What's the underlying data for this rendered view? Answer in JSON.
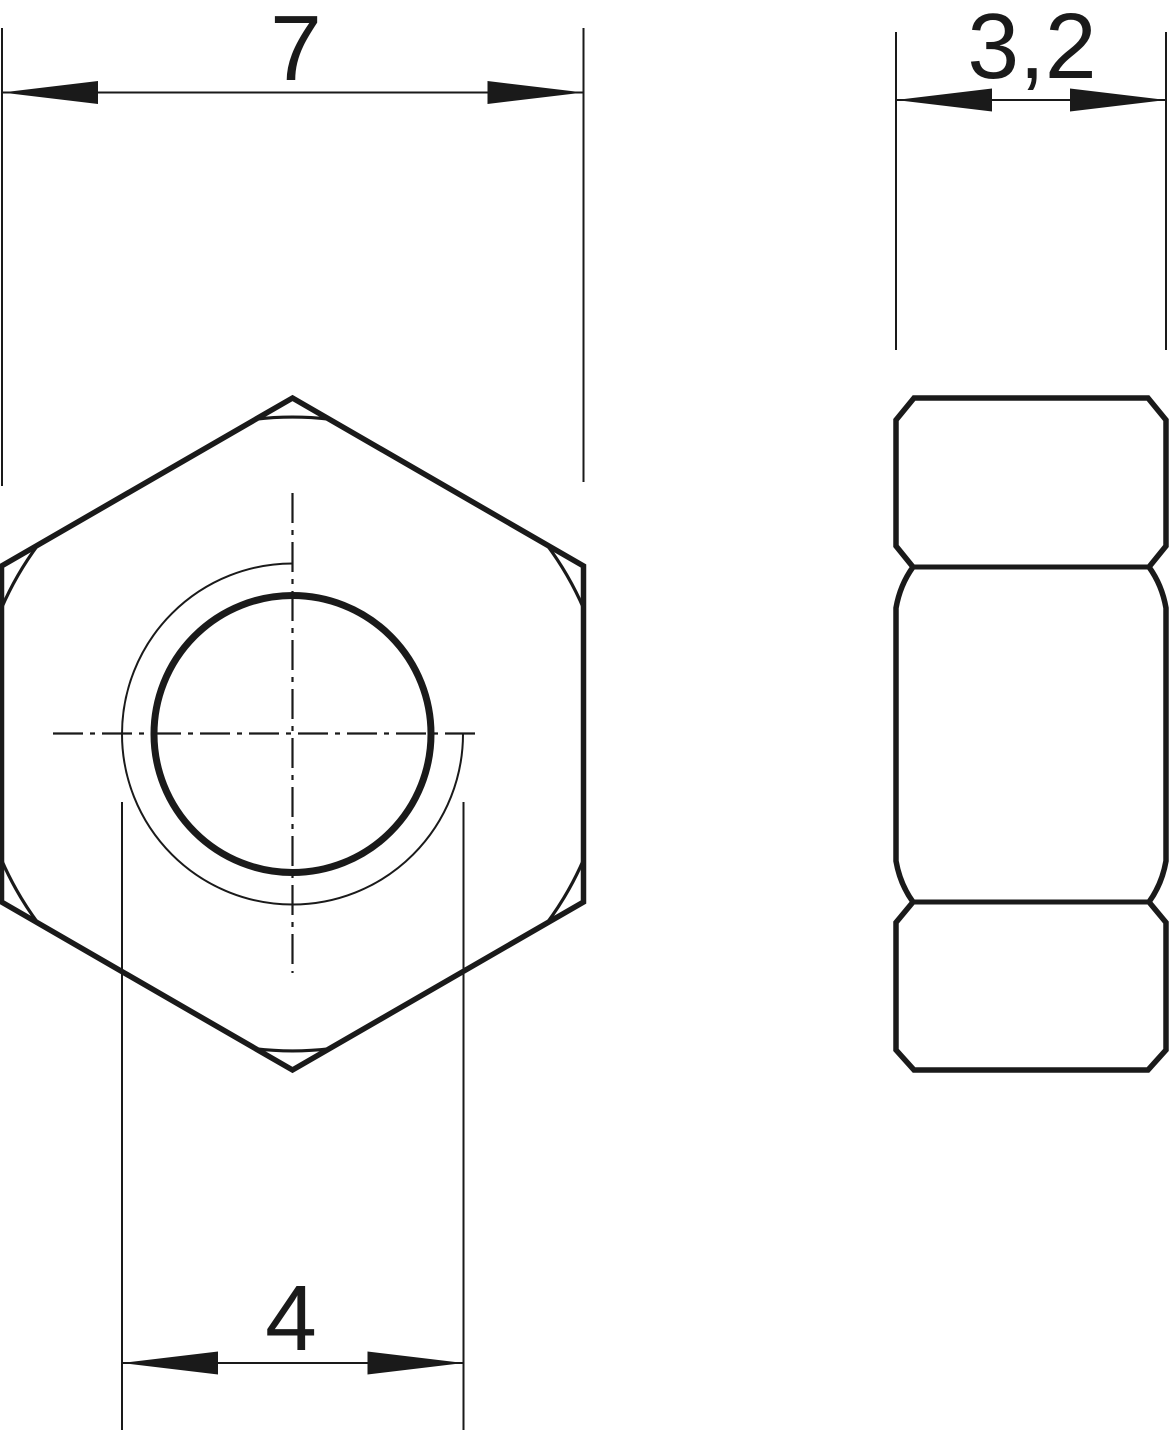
{
  "drawing": {
    "type": "technical-drawing",
    "subject": "hex nut, two orthographic views",
    "background": "#ffffff",
    "line_color": "#1a1a1a",
    "views": {
      "front_view": "hexagon with threaded hole, centerlines and corner chamfer arcs",
      "side_view": "nut thickness profile with chamfered corners and two face lines"
    },
    "dimensions": {
      "across_flats_label": "7",
      "thread_diameter_label": "4",
      "thickness_label": "3,2"
    }
  }
}
